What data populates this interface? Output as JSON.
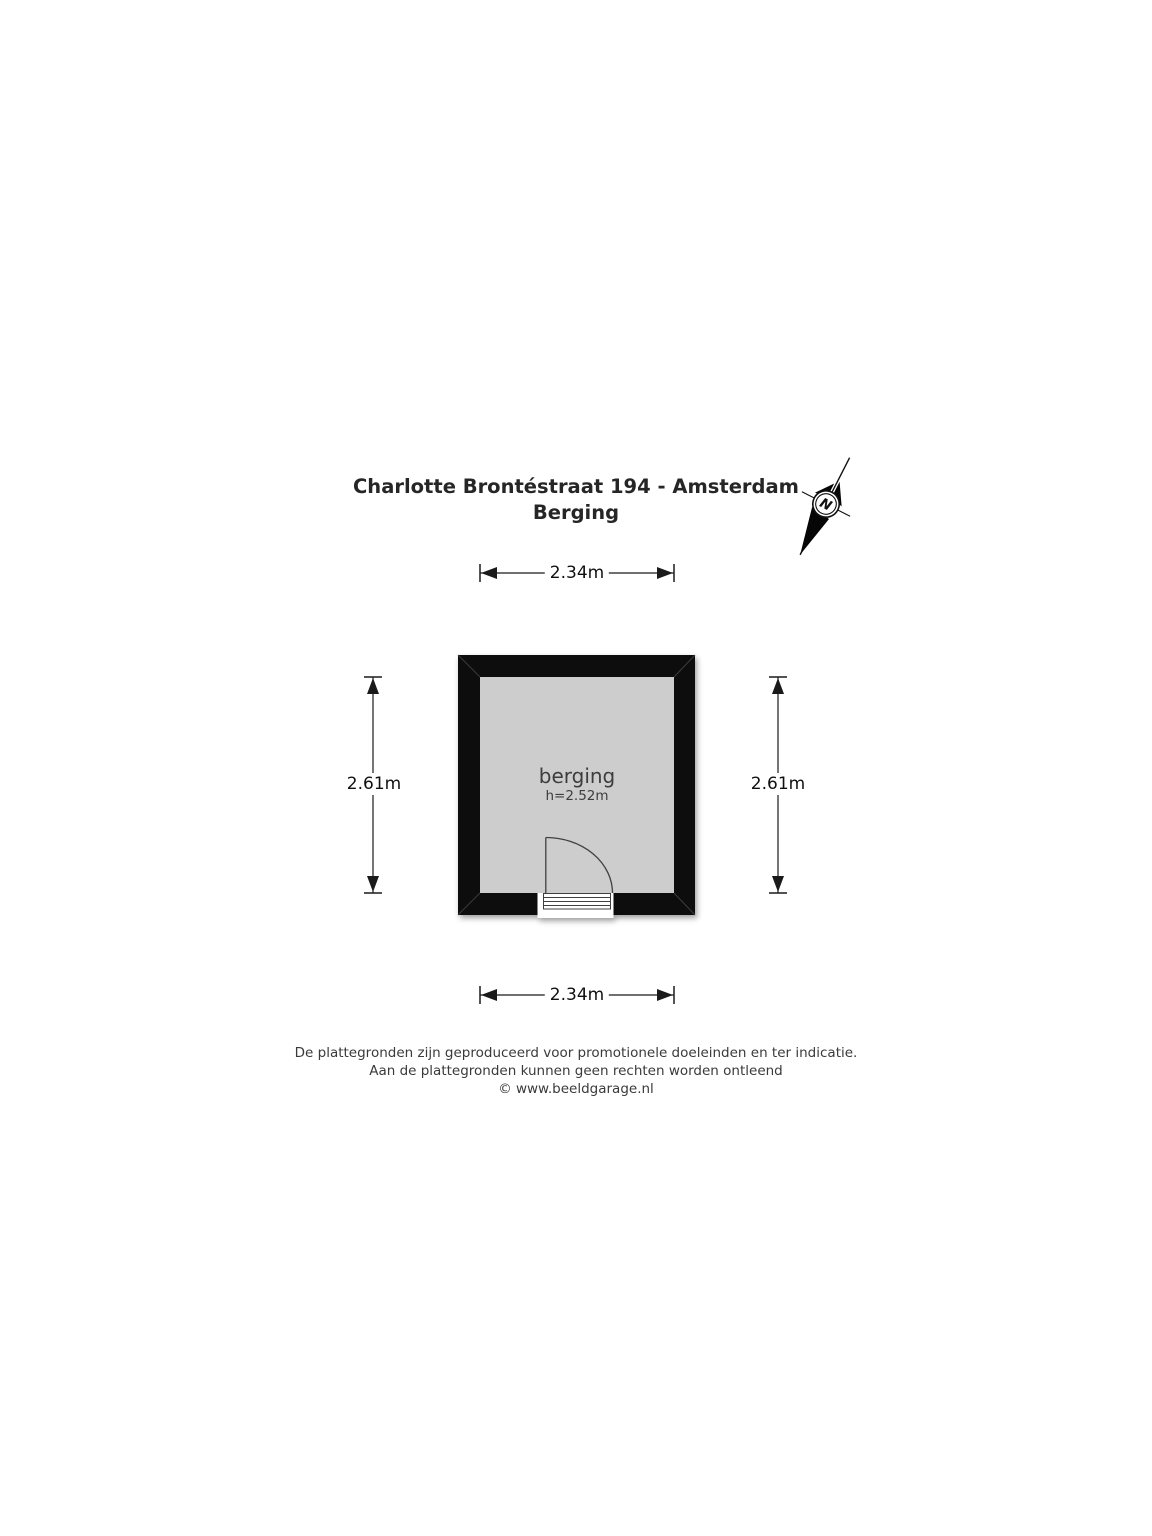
{
  "header": {
    "title": "Charlotte Brontéstraat 194 - Amsterdam",
    "subtitle": "Berging"
  },
  "floorplan": {
    "room": {
      "name": "berging",
      "ceiling_height": "h=2.52m"
    },
    "dimensions": {
      "width_top": "2.34m",
      "width_bottom": "2.34m",
      "height_left": "2.61m",
      "height_right": "2.61m"
    },
    "compass": {
      "north_label": "N"
    },
    "colors": {
      "wall": "#0b0b0b",
      "floor": "#cdcdcd",
      "outline": "#3f3f3f",
      "dimension_line": "#1a1a1a"
    }
  },
  "footer": {
    "lines": [
      "De plattegronden zijn geproduceerd voor promotionele doeleinden en ter indicatie.",
      "Aan de plattegronden kunnen geen rechten worden ontleend",
      "© www.beeldgarage.nl"
    ]
  }
}
